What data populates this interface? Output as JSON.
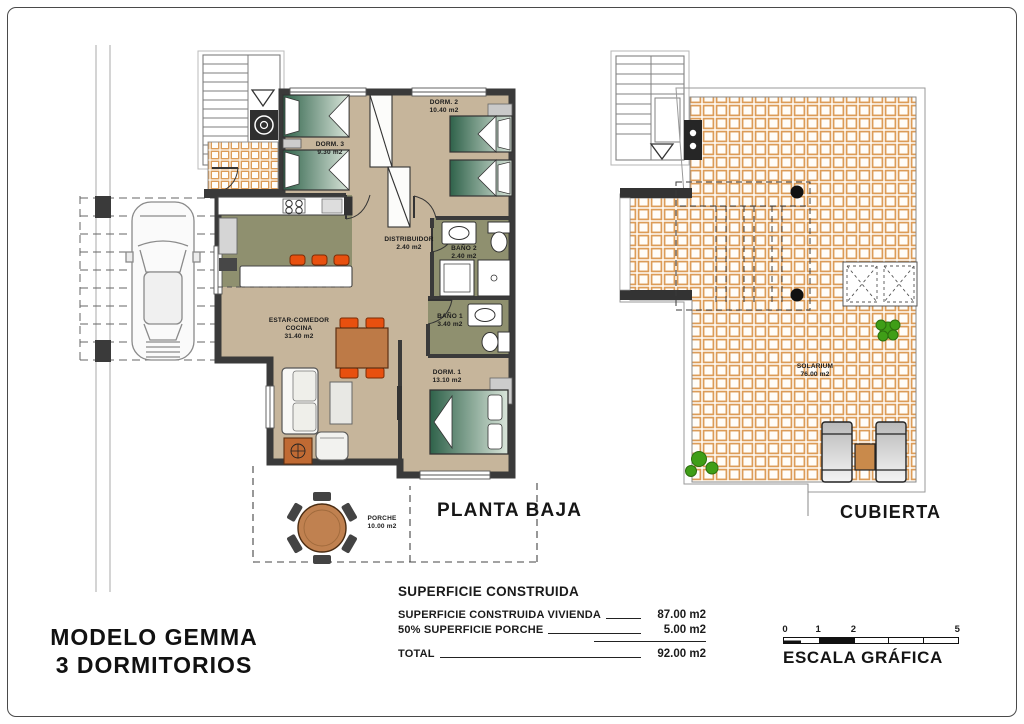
{
  "document": {
    "model_name_line1": "MODELO GEMMA",
    "model_name_line2": "3 DORMITORIOS"
  },
  "ground_plan": {
    "title": "PLANTA BAJA",
    "rooms": {
      "dorm3": {
        "name": "DORM. 3",
        "area": "9.30 m2"
      },
      "dorm2": {
        "name": "DORM. 2",
        "area": "10.40 m2"
      },
      "distribuidor": {
        "name": "DISTRIBUIDOR",
        "area": "2.40 m2"
      },
      "bano2": {
        "name": "BAÑO 2",
        "area": "2.40 m2"
      },
      "bano1": {
        "name": "BAÑO 1",
        "area": "3.40 m2"
      },
      "dorm1": {
        "name": "DORM. 1",
        "area": "13.10 m2"
      },
      "estar": {
        "name": "ESTAR-COMEDOR",
        "name2": "COCINA",
        "area": "31.40 m2"
      },
      "porche": {
        "name": "PORCHE",
        "area": "10.00 m2"
      }
    }
  },
  "roof_plan": {
    "title": "CUBIERTA",
    "rooms": {
      "solarium": {
        "name": "SOLARIUM",
        "area": "76.00 m2"
      }
    }
  },
  "surface_table": {
    "title": "SUPERFICIE CONSTRUIDA",
    "rows": [
      {
        "label": "SUPERFICIE CONSTRUIDA VIVIENDA",
        "value": "87.00 m2"
      },
      {
        "label": "50% SUPERFICIE PORCHE",
        "value": "5.00 m2"
      }
    ],
    "total": {
      "label": "TOTAL",
      "value": "92.00 m2"
    }
  },
  "scale_bar": {
    "title": "ESCALA GRÁFICA",
    "ticks": [
      "0",
      "1",
      "2",
      "5"
    ]
  }
}
